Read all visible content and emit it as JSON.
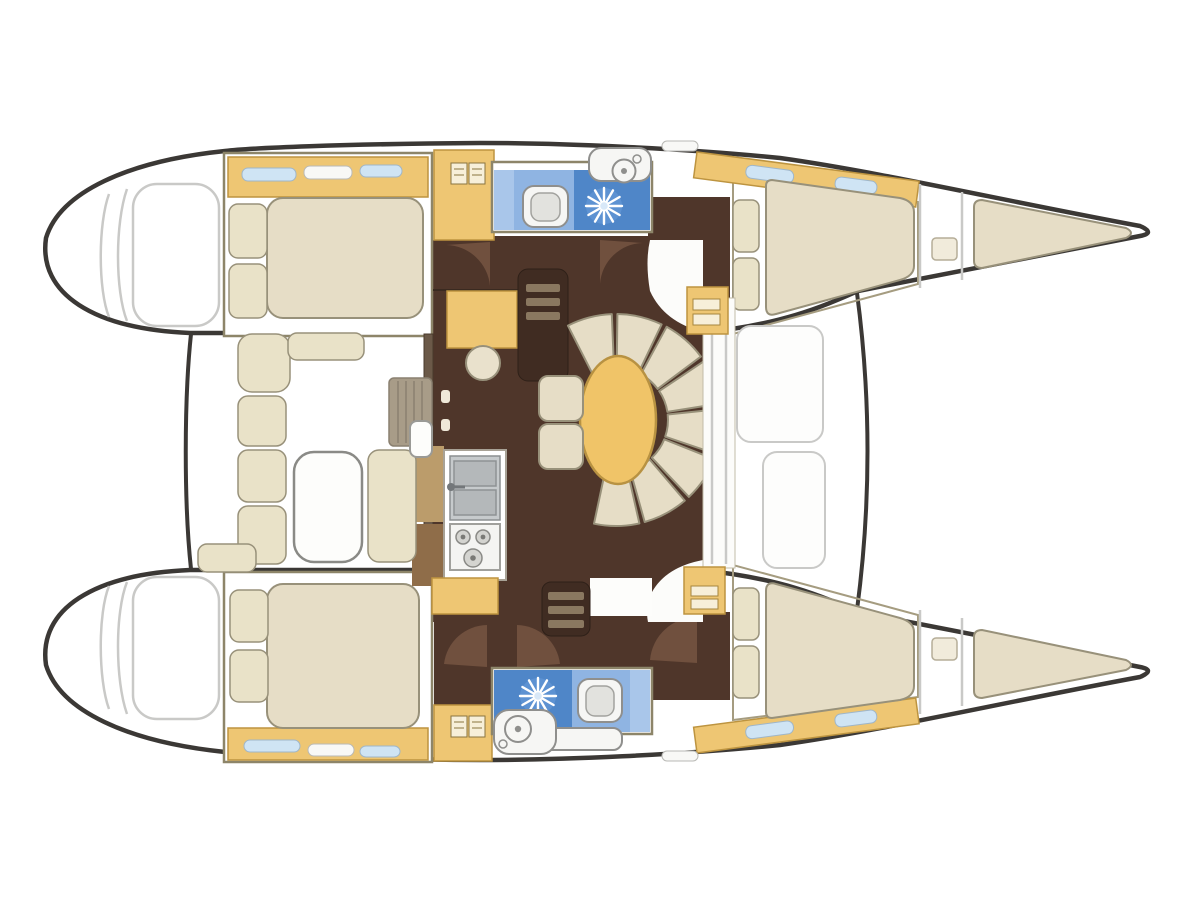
{
  "diagram": {
    "title": "Catamaran interior layout floor plan, top view with bow pointing right",
    "type": "boat-floor-plan",
    "vessel": "sailing catamaran, 4-cabin / 2-head charter layout",
    "orientation": "bow-right",
    "port_hull": {
      "position": "top",
      "rooms": [
        "transom swim steps (ghosted)",
        "aft double cabin with pillows and hull windows",
        "wardrobe locker",
        "head with toilet, washbasin and shower",
        "companionway passage with doors",
        "forward double berth",
        "forepeak berth cushion"
      ]
    },
    "starboard_hull": {
      "position": "bottom",
      "rooms": [
        "transom swim steps (ghosted)",
        "aft double cabin with pillows and hull windows",
        "wardrobe locker",
        "head with shower, toilet and washbasin",
        "companionway passage with doors",
        "forward double berth",
        "forepeak berth cushion"
      ]
    },
    "bridgedeck_saloon": {
      "features": [
        "navigation desk with stool",
        "oval saloon table",
        "curved horseshoe settee of upholstered segments",
        "two-cushion bench",
        "galley counter with twin stainless sink and faucet",
        "three-burner stove",
        "companionway steps down to each hull",
        "sliding-door front wall with corner cabinets"
      ]
    },
    "cockpit": {
      "position": "aft between hulls",
      "features": [
        "L-shaped bench seating",
        "cockpit table",
        "side seat cushion",
        "entry steps to saloon",
        "open sliding door leaf"
      ]
    },
    "foredeck": {
      "features": [
        "twin trampoline panels",
        "curved forward crossbeam"
      ]
    }
  },
  "colors": {
    "background": "#ffffff",
    "hull_outline": "#3b3835",
    "ghost_line": "#c9c9c7",
    "wall_olive": "#8d8569",
    "wood_yellow": "#eec673",
    "wood_yellow_dark": "#bd9440",
    "wood_tan": "#bb9c6b",
    "wood_brown": "#8f6d49",
    "floor_brown": "#4f362a",
    "door_brown": "#70503e",
    "steps_dark": "#402c22",
    "steps_bar": "#8a7860",
    "bed_beige": "#e6ddc6",
    "bed_border": "#98917a",
    "cushion_pale": "#e9e2c8",
    "table_yellow": "#f0c468",
    "table_border": "#b89242",
    "bath_blue_pale": "#a9c6ea",
    "bath_blue_light": "#8fb4e2",
    "bath_blue_dark": "#4f86c8",
    "fixture_white": "#f6f6f4",
    "fixture_border": "#8f8f8d",
    "steel_gray": "#c6cacc",
    "window_blue": "#cfe4f4",
    "window_white": "#f8f8f6"
  }
}
